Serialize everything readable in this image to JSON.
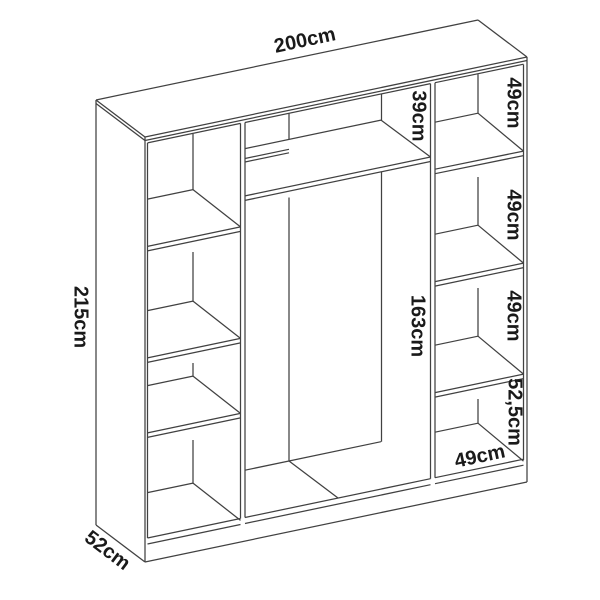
{
  "colors": {
    "line": "#414141",
    "text": "#1a1a1a",
    "background": "#ffffff"
  },
  "labels": {
    "overall_width": "200cm",
    "overall_height": "215cm",
    "overall_depth": "52cm",
    "top_shelf_height": "39cm",
    "middle_height": "163cm",
    "right_shelf_1": "49cm",
    "right_shelf_2": "49cm",
    "right_shelf_3": "49cm",
    "right_bottom": "52,5cm",
    "right_width": "49cm"
  }
}
